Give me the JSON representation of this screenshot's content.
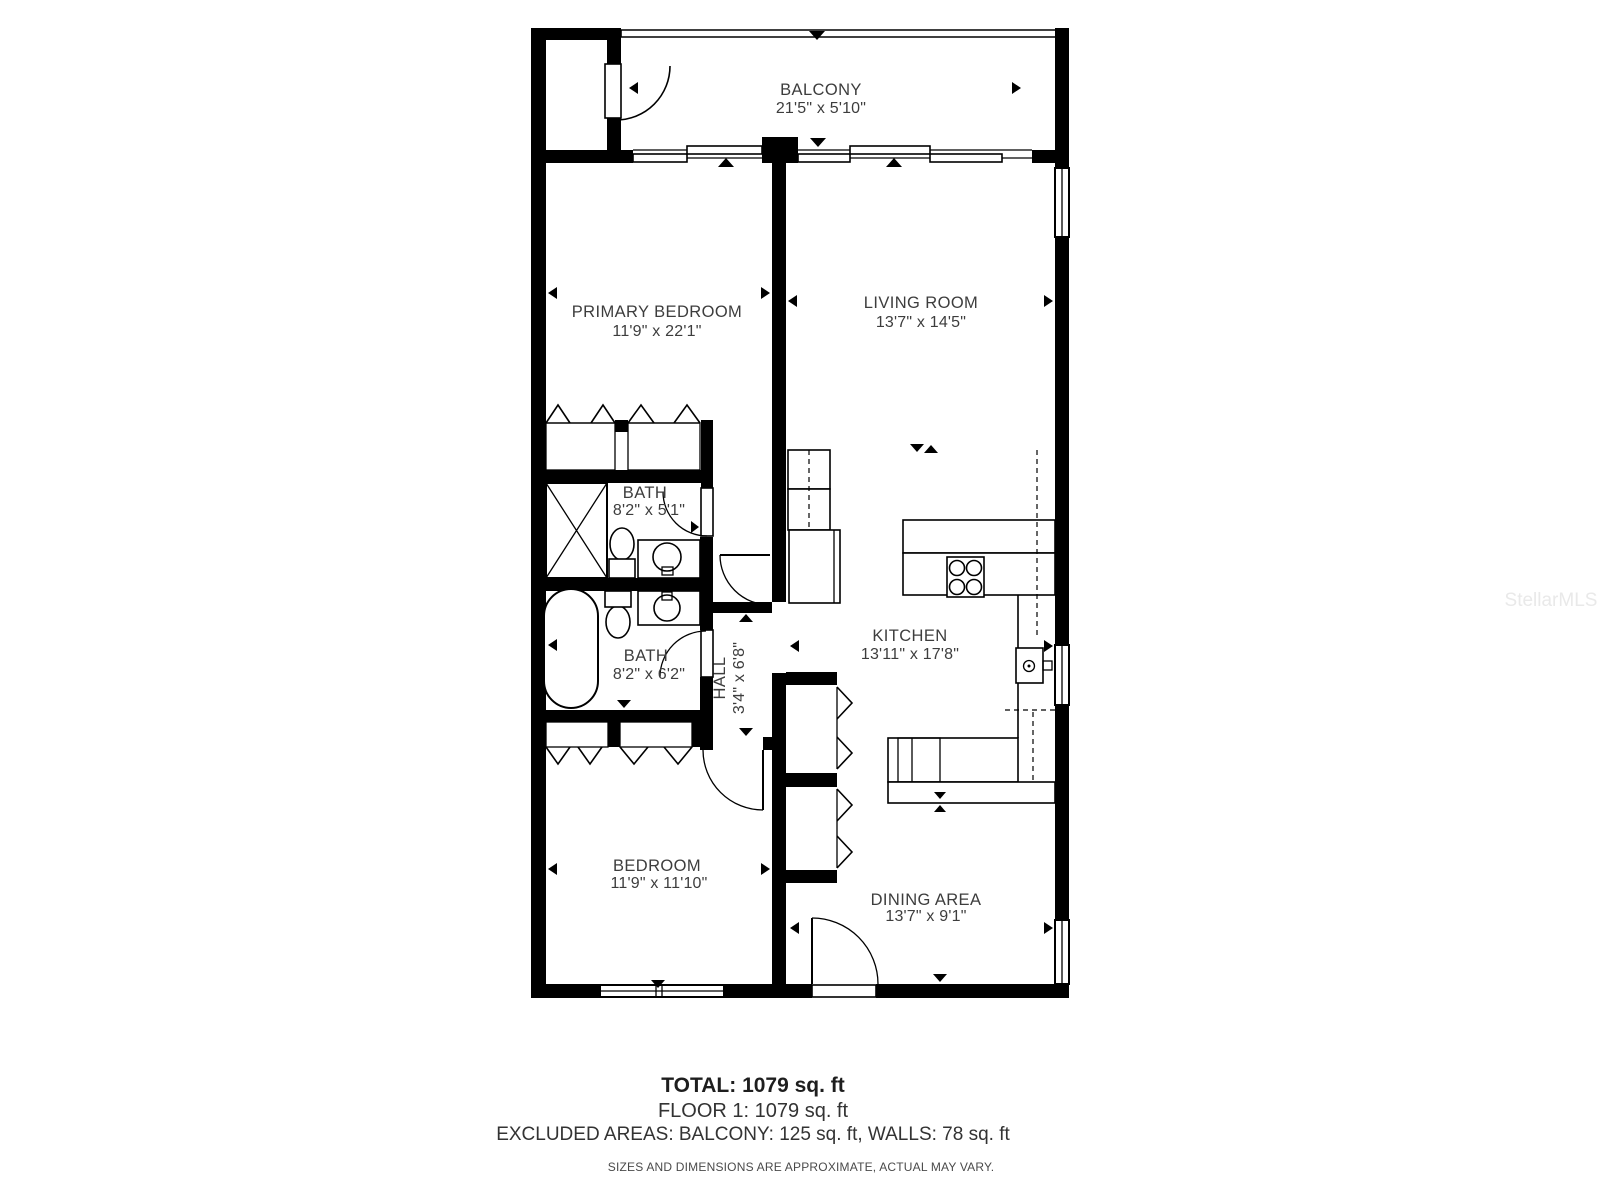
{
  "watermark": "StellarMLS",
  "rooms": {
    "balcony": {
      "name": "BALCONY",
      "dims": "21'5\" x 5'10\""
    },
    "primary_bedroom": {
      "name": "PRIMARY BEDROOM",
      "dims": "11'9\" x 22'1\""
    },
    "living_room": {
      "name": "LIVING ROOM",
      "dims": "13'7\" x 14'5\""
    },
    "bath_upper": {
      "name": "BATH",
      "dims": "8'2\" x 5'1\""
    },
    "bath_lower": {
      "name": "BATH",
      "dims": "8'2\" x 6'2\""
    },
    "hall": {
      "name": "HALL",
      "dims": "3'4\" x 6'8\""
    },
    "kitchen": {
      "name": "KITCHEN",
      "dims": "13'11\" x 17'8\""
    },
    "bedroom": {
      "name": "BEDROOM",
      "dims": "11'9\" x 11'10\""
    },
    "dining_area": {
      "name": "DINING AREA",
      "dims": "13'7\" x 9'1\""
    }
  },
  "summary": {
    "total": "TOTAL: 1079 sq. ft",
    "floor": "FLOOR 1: 1079 sq. ft",
    "excluded": "EXCLUDED AREAS: BALCONY: 125 sq. ft, WALLS: 78 sq. ft",
    "disclaimer": "SIZES AND DIMENSIONS ARE APPROXIMATE, ACTUAL MAY VARY."
  }
}
